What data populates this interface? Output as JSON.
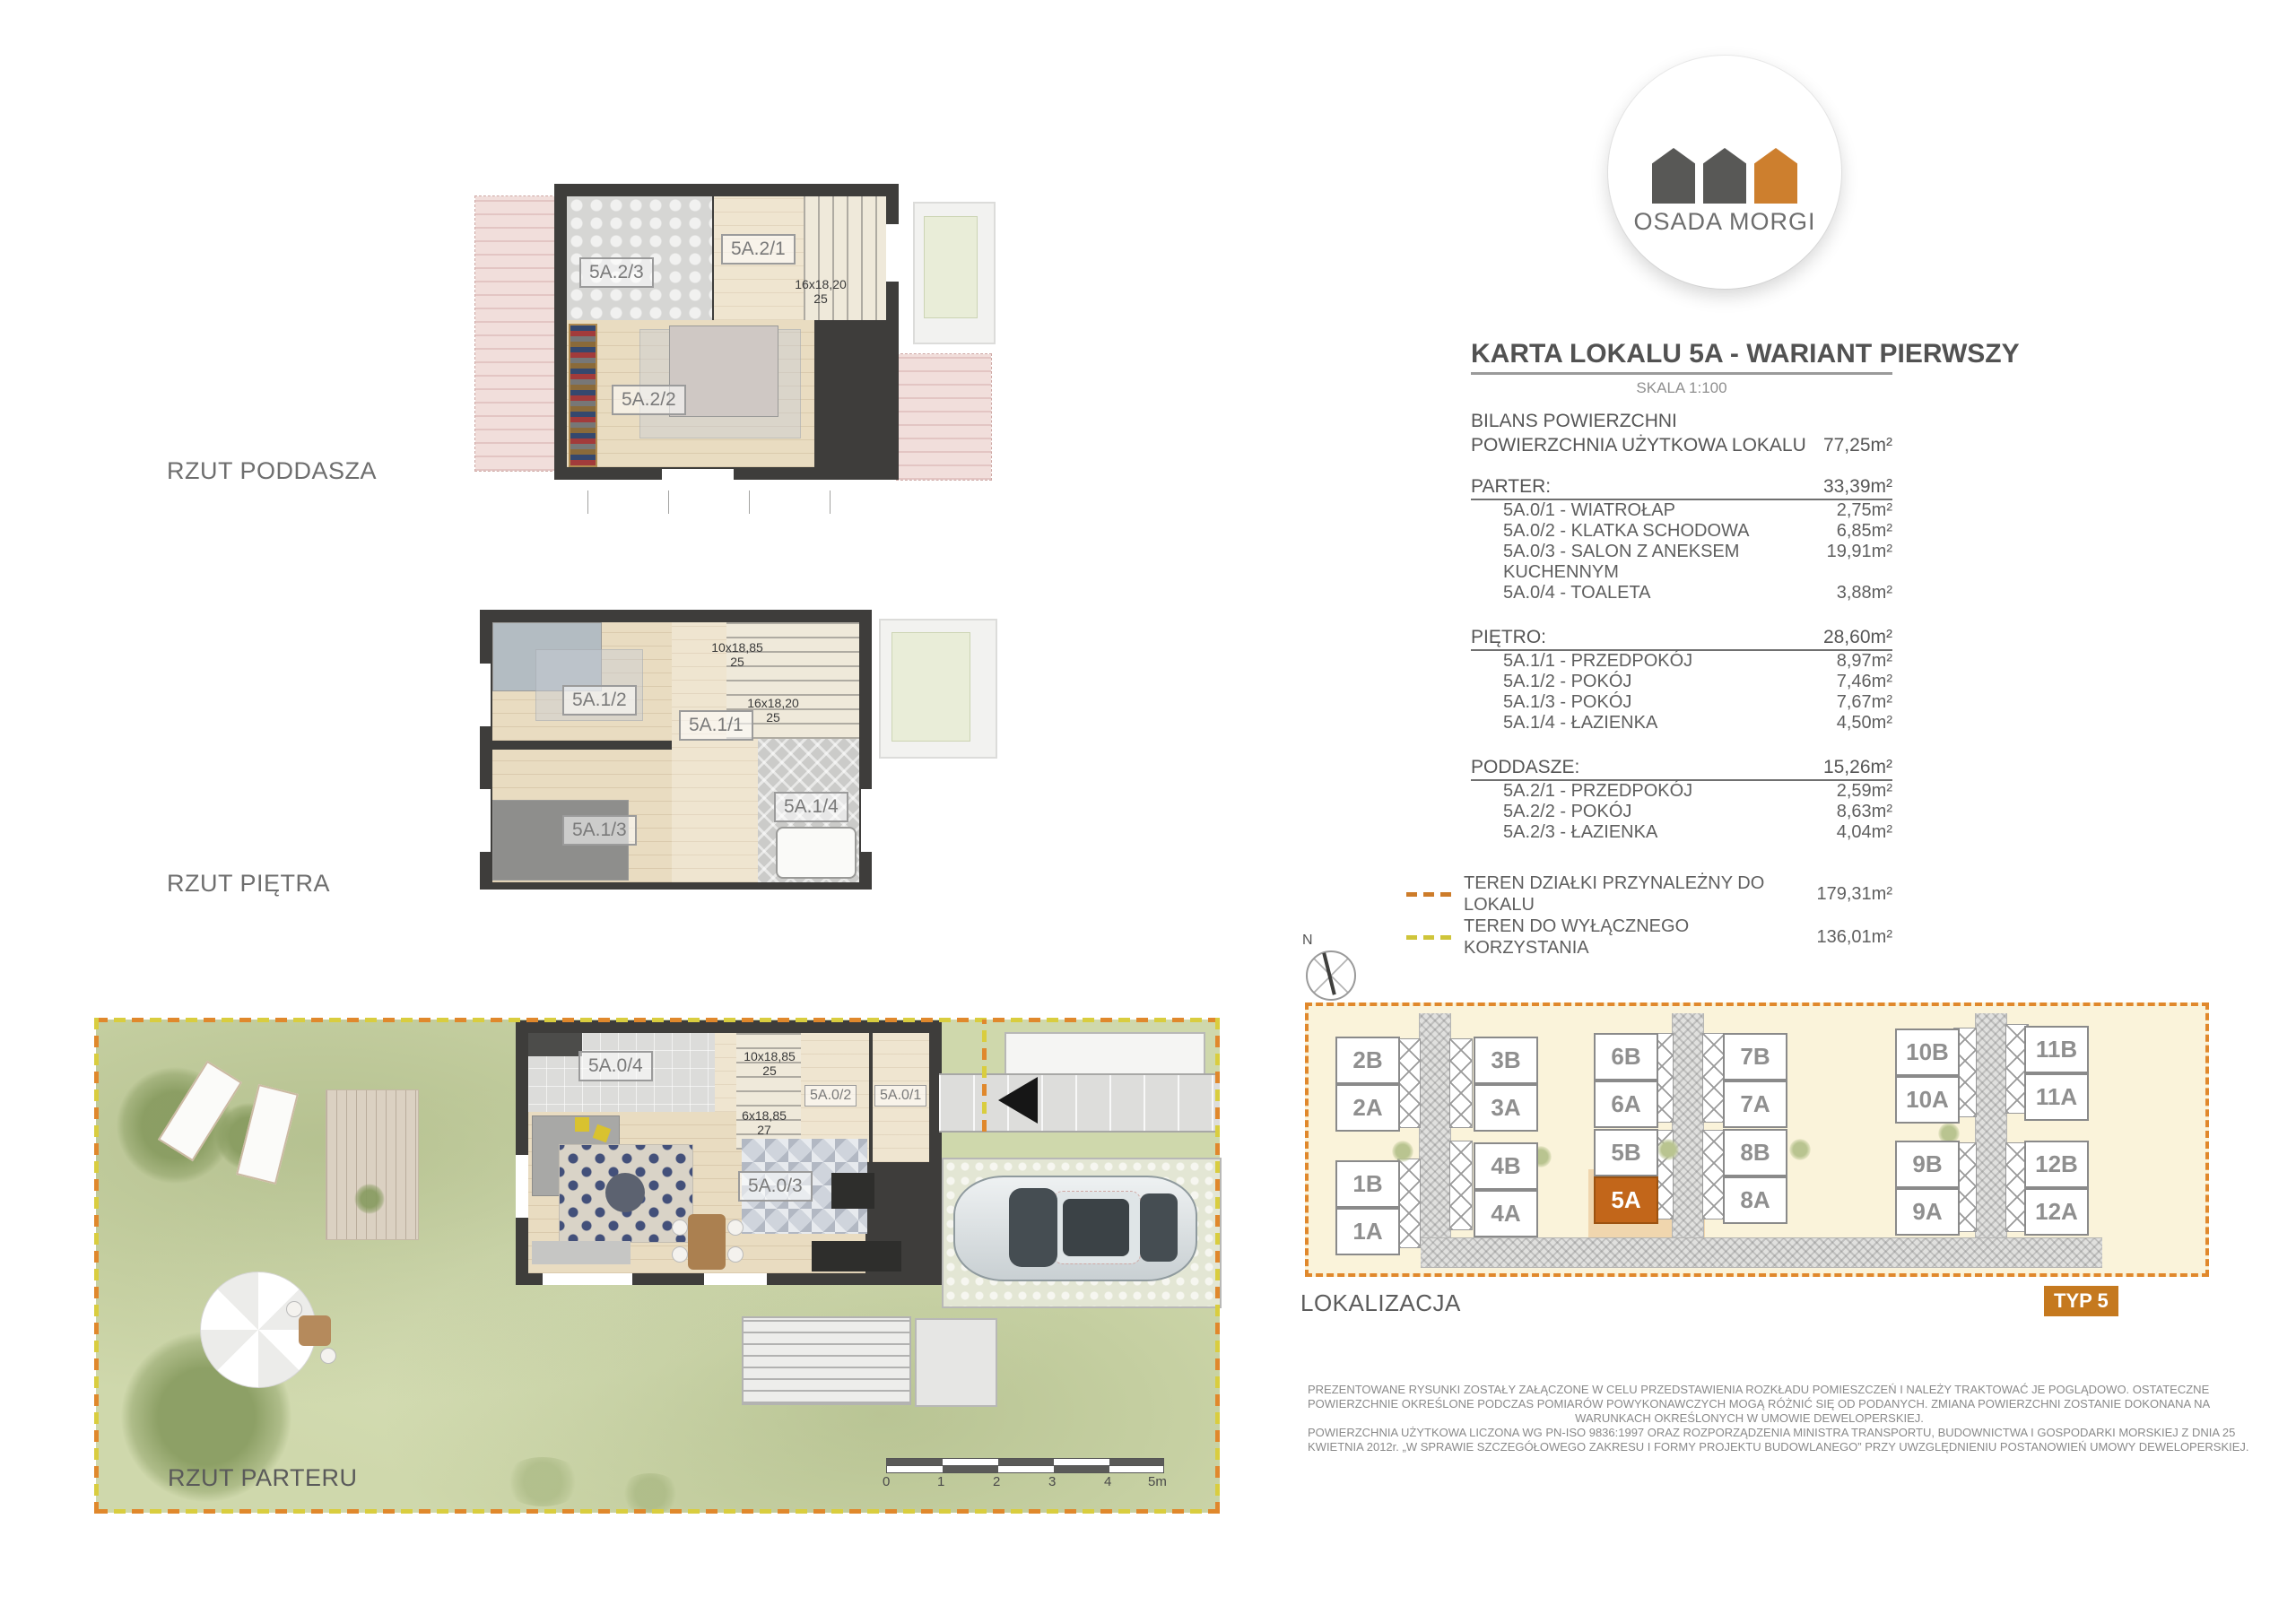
{
  "logo": {
    "name": "OSADA MORGI"
  },
  "header": {
    "title": "KARTA LOKALU 5A - WARIANT PIERWSZY",
    "scale": "SKALA 1:100",
    "bilans_heading": "BILANS POWIERZCHNI",
    "total_label": "POWIERZCHNIA UŻYTKOWA LOKALU",
    "total_value": "77,25m²"
  },
  "sections": [
    {
      "label": "PARTER:",
      "value": "33,39m²",
      "rows": [
        {
          "label": "5A.0/1 - WIATROŁAP",
          "value": "2,75m²"
        },
        {
          "label": "5A.0/2 - KLATKA SCHODOWA",
          "value": "6,85m²"
        },
        {
          "label": "5A.0/3 - SALON Z ANEKSEM KUCHENNYM",
          "value": "19,91m²"
        },
        {
          "label": "5A.0/4 - TOALETA",
          "value": "3,88m²"
        }
      ]
    },
    {
      "label": "PIĘTRO:",
      "value": "28,60m²",
      "rows": [
        {
          "label": "5A.1/1 - PRZEDPOKÓJ",
          "value": "8,97m²"
        },
        {
          "label": "5A.1/2 - POKÓJ",
          "value": "7,46m²"
        },
        {
          "label": "5A.1/3 - POKÓJ",
          "value": "7,67m²"
        },
        {
          "label": "5A.1/4 - ŁAZIENKA",
          "value": "4,50m²"
        }
      ]
    },
    {
      "label": "PODDASZE:",
      "value": "15,26m²",
      "rows": [
        {
          "label": "5A.2/1 - PRZEDPOKÓJ",
          "value": "2,59m²"
        },
        {
          "label": "5A.2/2 - POKÓJ",
          "value": "8,63m²"
        },
        {
          "label": "5A.2/3 - ŁAZIENKA",
          "value": "4,04m²"
        }
      ]
    }
  ],
  "legend": [
    {
      "label": "TEREN DZIAŁKI PRZYNALEŻNY DO LOKALU",
      "value": "179,31m²",
      "color": "#cd7c2a"
    },
    {
      "label": "TEREN DO WYŁĄCZNEGO KORZYSTANIA",
      "value": "136,01m²",
      "color": "#cfc53a"
    }
  ],
  "plans": {
    "poddasze": {
      "title": "RZUT PODDASZA",
      "room_21": "5A.2/1",
      "room_22": "5A.2/2",
      "room_23": "5A.2/3",
      "stair_a1": "16x18,20",
      "stair_a2": "25"
    },
    "pietro": {
      "title": "RZUT PIĘTRA",
      "room_11": "5A.1/1",
      "room_12": "5A.1/2",
      "room_13": "5A.1/3",
      "room_14": "5A.1/4",
      "stair_a1": "10x18,85",
      "stair_a2": "25",
      "stair_b1": "16x18,20",
      "stair_b2": "25"
    },
    "parter": {
      "title": "RZUT PARTERU",
      "room_01": "5A.0/1",
      "room_02": "5A.0/2",
      "room_03": "5A.0/3",
      "room_04": "5A.0/4",
      "stair_a1": "10x18,85",
      "stair_a2": "25",
      "stair_b1": "6x18,85",
      "stair_b2": "27"
    }
  },
  "scalebar": {
    "ticks": [
      "0",
      "1",
      "2",
      "3",
      "4",
      "5m"
    ]
  },
  "sitemap": {
    "label": "LOKALIZACJA",
    "badge": "TYP 5",
    "compass_n": "N",
    "highlight_color": "#c2661a",
    "units": {
      "u2b": "2B",
      "u2a": "2A",
      "u1b": "1B",
      "u1a": "1A",
      "u3b": "3B",
      "u3a": "3A",
      "u4b": "4B",
      "u4a": "4A",
      "u6b": "6B",
      "u6a": "6A",
      "u5b": "5B",
      "u5a": "5A",
      "u7b": "7B",
      "u7a": "7A",
      "u8b": "8B",
      "u8a": "8A",
      "u10b": "10B",
      "u10a": "10A",
      "u9b": "9B",
      "u9a": "9A",
      "u11b": "11B",
      "u11a": "11A",
      "u12b": "12B",
      "u12a": "12A"
    }
  },
  "disclaimer": {
    "line1": "PREZENTOWANE RYSUNKI ZOSTAŁY ZAŁĄCZONE W CELU PRZEDSTAWIENIA ROZKŁADU POMIESZCZEŃ I NALEŻY TRAKTOWAĆ JE POGLĄDOWO. OSTATECZNE",
    "line2": "POWIERZCHNIE OKREŚLONE PODCZAS POMIARÓW POWYKONAWCZYCH MOGĄ RÓŻNIĆ SIĘ OD PODANYCH. ZMIANA POWIERZCHNI ZOSTANIE DOKONANA NA",
    "line3": "WARUNKACH OKREŚLONYCH W UMOWIE DEWELOPERSKIEJ.",
    "line4": "POWIERZCHNIA UŻYTKOWA LICZONA WG PN-ISO 9836:1997 ORAZ ROZPORZĄDZENIA MINISTRA TRANSPORTU, BUDOWNICTWA I GOSPODARKI MORSKIEJ Z DNIA 25",
    "line5": "KWIETNIA 2012r.   „W SPRAWIE SZCZEGÓŁOWEGO ZAKRESU I FORMY PROJEKTU BUDOWLANEGO” PRZY UWZGLĘDNIENIU POSTANOWIEŃ UMOWY DEWELOPERSKIEJ."
  }
}
